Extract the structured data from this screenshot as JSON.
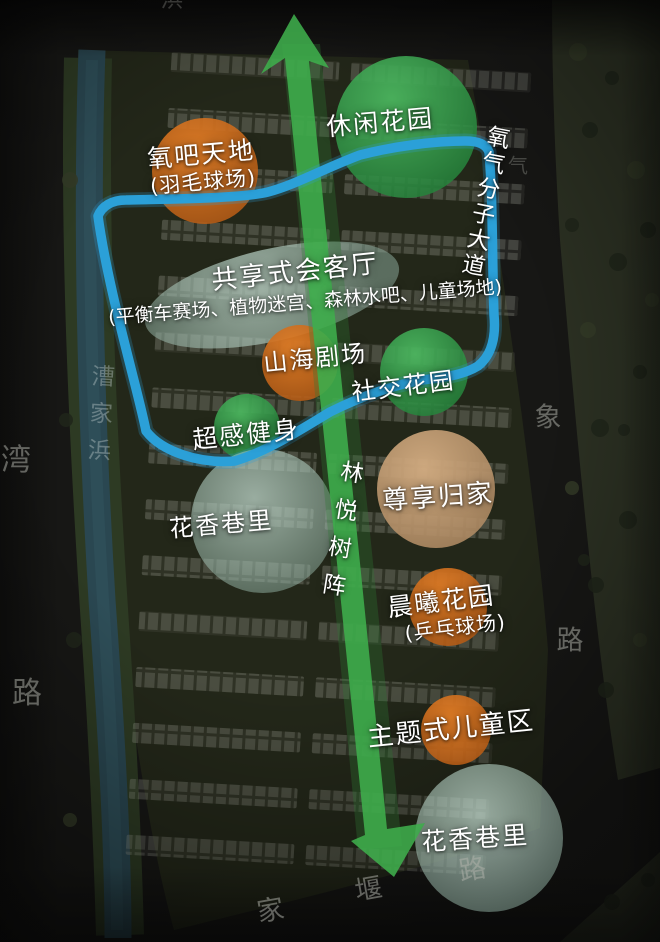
{
  "map": {
    "zones": [
      {
        "id": "leisure-garden",
        "label": "休闲花园",
        "sublabel": "",
        "color": "green"
      },
      {
        "id": "oxygen-bar-world",
        "label": "氧吧天地",
        "sublabel": "(羽毛球场)",
        "color": "orange"
      },
      {
        "id": "shared-living-room",
        "label": "共享式会客厅",
        "sublabel": "(平衡车赛场、植物迷宫、森林水吧、儿童场地)",
        "color": "teal"
      },
      {
        "id": "mountain-sea-theater",
        "label": "山海剧场",
        "sublabel": "",
        "color": "orange"
      },
      {
        "id": "social-garden",
        "label": "社交花园",
        "sublabel": "",
        "color": "green"
      },
      {
        "id": "super-sense-fitness",
        "label": "超感健身",
        "sublabel": "",
        "color": "green"
      },
      {
        "id": "flower-alley-upper",
        "label": "花香巷里",
        "sublabel": "",
        "color": "teal"
      },
      {
        "id": "premium-homecoming",
        "label": "尊享归家",
        "sublabel": "",
        "color": "tan"
      },
      {
        "id": "morning-glow-garden",
        "label": "晨曦花园",
        "sublabel": "(乒乓球场)",
        "color": "orange"
      },
      {
        "id": "themed-children-zone",
        "label": "主题式儿童区",
        "sublabel": "",
        "color": "orange"
      },
      {
        "id": "flower-alley-lower",
        "label": "花香巷里",
        "sublabel": "",
        "color": "teal"
      }
    ],
    "axis": {
      "tree_array_label": "林悦树阵",
      "avenue_label": "氧气分子大道"
    },
    "roads": {
      "river_name": "漕家浜",
      "left_road_chars": [
        "湾",
        "路"
      ],
      "right_road_chars": [
        "气",
        "象",
        "路"
      ],
      "bottom_road_chars": [
        "家",
        "堰",
        "路"
      ],
      "top_edge_char": "浜"
    },
    "colors": {
      "zone_green": "#2f9a47",
      "zone_orange": "#cf6b1e",
      "zone_tan": "#c29a6f",
      "zone_teal": "#a7c6b8",
      "axis_arrow": "#3fae4c",
      "route_loop": "#2ba0da",
      "label_text": "#ffffff",
      "road_text": "#9a9a95"
    }
  }
}
